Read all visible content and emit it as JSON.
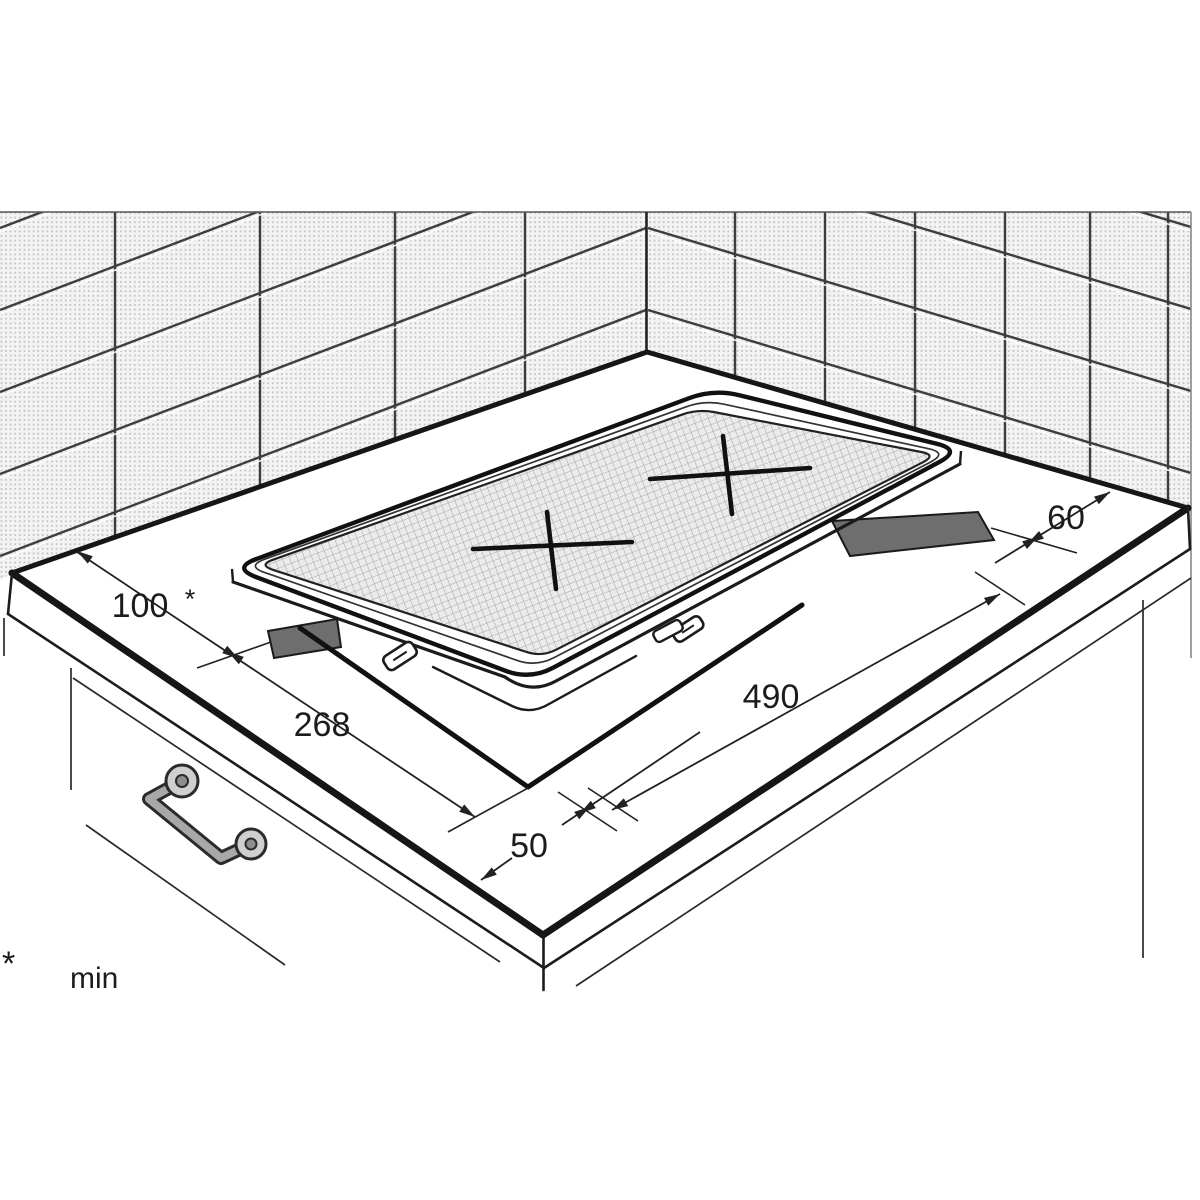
{
  "figure": {
    "type": "installation-diagram",
    "subject": "built-in hob worktop cutout with clearance dimensions"
  },
  "dimensions": {
    "wall_clearance": {
      "value": "100",
      "asterisk": "*"
    },
    "cutout_depth": "268",
    "cutout_length": "490",
    "front_clearance": "50",
    "side_clearance": "60"
  },
  "footnote": {
    "symbol": "*",
    "text": "min"
  },
  "colors": {
    "line_art": "#1a1a1a",
    "tile_fill": "#f3f3f3",
    "glass_fill": "#ebebeb",
    "cutout_shadow": "#6e6e6e"
  }
}
